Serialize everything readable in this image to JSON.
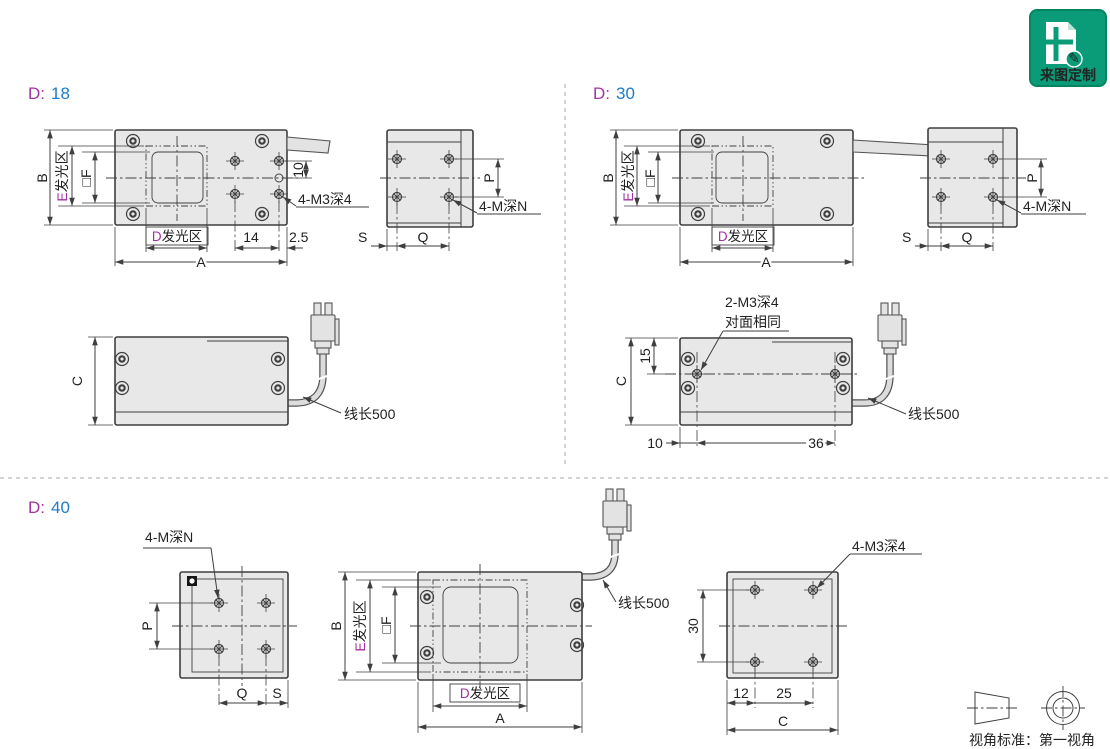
{
  "badge": {
    "label": "来图定制"
  },
  "projection": {
    "label": "视角标准：第一视角"
  },
  "colors": {
    "accent_magenta": "#A232A0",
    "accent_blue": "#1E7BC4",
    "body_fill": "#E8E8E8",
    "line": "#3F3F3F",
    "badge_green": "#0A9C79"
  },
  "sections": {
    "d18": {
      "title_prefix": "D:",
      "title_value": "18",
      "plan": {
        "B": "B",
        "E_prefix": "E",
        "E_area": "发光区",
        "F": "□F",
        "D_prefix": "D",
        "D_area": "发光区",
        "A": "A",
        "dim_14": "14",
        "dim_2_5": "2.5",
        "dim_10": "10",
        "hole_note": "4-M3深4"
      },
      "end": {
        "P": "P",
        "Q": "Q",
        "S": "S",
        "hole_note": "4-M深N"
      },
      "side": {
        "C": "C",
        "wire": "线长500"
      }
    },
    "d30": {
      "title_prefix": "D:",
      "title_value": "30",
      "plan": {
        "B": "B",
        "E_prefix": "E",
        "E_area": "发光区",
        "F": "□F",
        "D_prefix": "D",
        "D_area": "发光区",
        "A": "A"
      },
      "end": {
        "P": "P",
        "Q": "Q",
        "S": "S",
        "hole_note": "4-M深N"
      },
      "side": {
        "C": "C",
        "wire": "线长500",
        "hole_note": "2-M3深4",
        "hole_note2": "对面相同",
        "dim_15": "15",
        "dim_10": "10",
        "dim_36": "36"
      }
    },
    "d40": {
      "title_prefix": "D:",
      "title_value": "40",
      "back": {
        "P": "P",
        "Q": "Q",
        "S": "S",
        "hole_note": "4-M深N"
      },
      "plan": {
        "B": "B",
        "E_prefix": "E",
        "E_area": "发光区",
        "F": "□F",
        "D_prefix": "D",
        "D_area": "发光区",
        "A": "A",
        "wire": "线长500"
      },
      "end": {
        "hole_note": "4-M3深4",
        "dim_30": "30",
        "dim_12": "12",
        "dim_25": "25",
        "C": "C"
      }
    }
  }
}
